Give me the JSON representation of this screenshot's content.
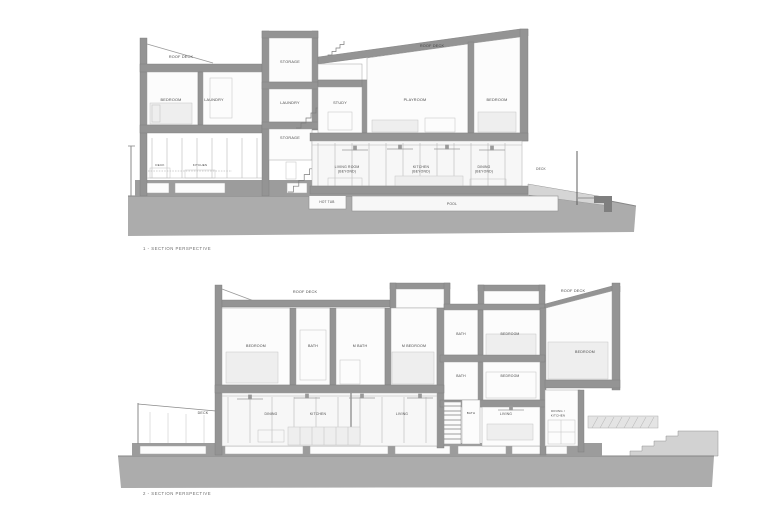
{
  "sheet": {
    "background": "#ffffff"
  },
  "palette": {
    "wall": "#949494",
    "ground": "#acacac",
    "terrain_light": "#d2d2d2",
    "room": "#fcfcfc",
    "label_text": "#474747",
    "caption_text": "#6e6e6e"
  },
  "drawing1": {
    "caption": "1 - SECTION PERSPECTIVE",
    "labels": {
      "roof_deck_left": "ROOF DECK",
      "bedroom_left": "BEDROOM",
      "laundry_upper": "LAUNDRY",
      "storage_top": "STORAGE",
      "laundry_mid": "LAUNDRY",
      "storage_lower": "STORAGE",
      "study": "STUDY",
      "roof_deck_right": "ROOF DECK",
      "playroom": "PLAYROOM",
      "bedroom_right": "BEDROOM",
      "deck_entry": "DECK",
      "kitchen_entry": "KITCHEN",
      "living_room": "LIVING ROOM",
      "living_room_sub": "(BEYOND)",
      "kitchen_beyond": "KITCHEN",
      "kitchen_beyond_sub": "(BEYOND)",
      "dining_beyond": "DINING",
      "dining_beyond_sub": "(BEYOND)",
      "hot_tub": "HOT TUB",
      "pool": "POOL",
      "deck_right": "DECK"
    }
  },
  "drawing2": {
    "caption": "2 - SECTION PERSPECTIVE",
    "labels": {
      "roof_deck_left": "ROOF DECK",
      "bedroom_nw": "BEDROOM",
      "bath_upper_left": "BATH",
      "master_bath": "M BATH",
      "master_bedroom": "M BEDROOM",
      "bath_upper_right": "BATH",
      "bedroom_upper_right": "BEDROOM",
      "bedroom_far_right": "BEDROOM",
      "roof_deck_right": "ROOF DECK",
      "bath_mid_right": "BATH",
      "bedroom_mid_right": "BEDROOM",
      "deck": "DECK",
      "dining": "DINING",
      "kitchen": "KITCHEN",
      "living_main": "LIVING",
      "bath_lower": "BATH",
      "living_suite": "LIVING",
      "dining_kitchen_line1": "DINING /",
      "dining_kitchen_line2": "KITCHEN"
    }
  }
}
